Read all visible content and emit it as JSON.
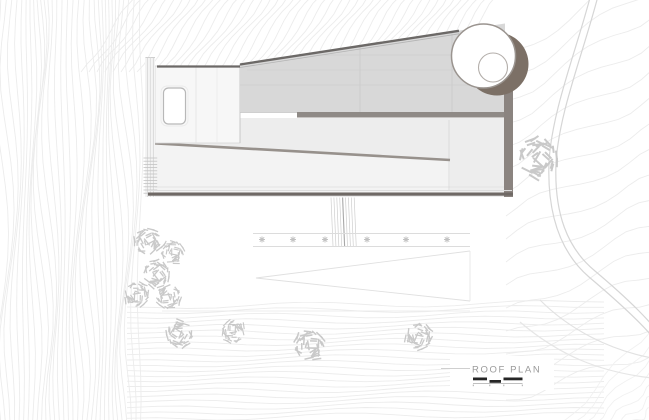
{
  "label": {
    "title": "ROOF PLAN"
  },
  "colors": {
    "background": "#ffffff",
    "contour": "#ececec",
    "contour_soft": "#f1f1f1",
    "road": "#d6d6d6",
    "tree": "#c9c9c9",
    "plant": "#c2c2c2",
    "roof_slope_fill": "#d8d8d8",
    "roof_mid_fill": "#ededed",
    "roof_lower_fill": "#f3f3f3",
    "roof_left_fill": "#f7f7f7",
    "edge_dark": "#6c6967",
    "diagonal_edge": "#97918c",
    "band_dark": "#8f8a86",
    "right_shadow": "#8b8480",
    "bottom_band": "#6f6965",
    "shadow": "#7c7066",
    "circle_stroke": "#9a948f",
    "inner_circle_stroke": "#b3aeaa",
    "label_text": "#9b9b9b",
    "leader_line": "#cfcfcf",
    "scale_black": "#262626"
  }
}
